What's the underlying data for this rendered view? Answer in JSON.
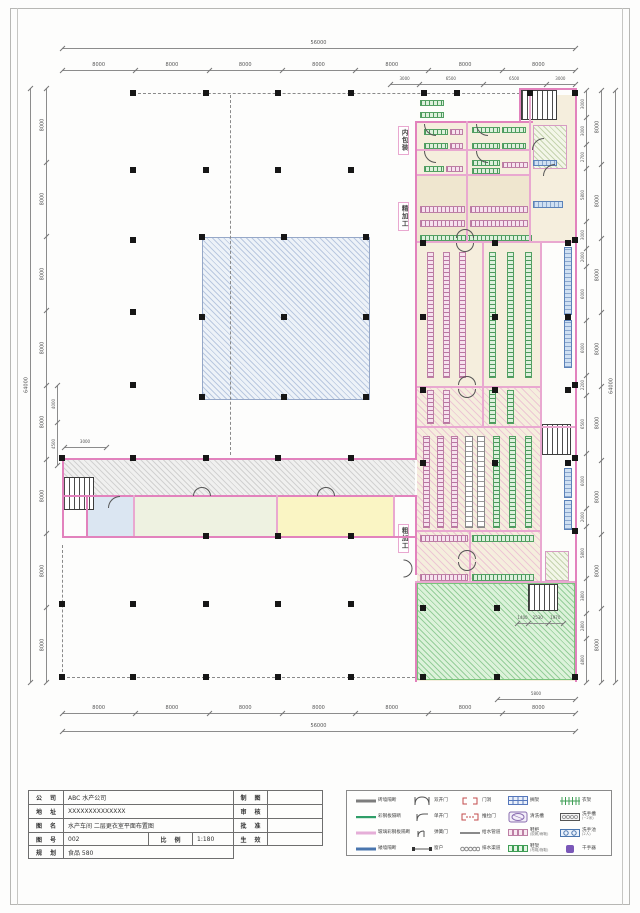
{
  "dims": {
    "top_total": "56000",
    "top": [
      "8000",
      "8000",
      "8000",
      "8000",
      "8000",
      "8000",
      "8000"
    ],
    "top_sub": [
      "3000",
      "6500",
      "6500",
      "3000"
    ],
    "bottom": [
      "8000",
      "8000",
      "8000",
      "8000",
      "8000",
      "8000",
      "8000"
    ],
    "bottom_total": "56000",
    "bottom_sub": "5800",
    "left_total": "64000",
    "left": [
      "8000",
      "8000",
      "8000",
      "8000",
      "8000",
      "8000",
      "8000",
      "8000"
    ],
    "left_sub": [
      "4000",
      "4500"
    ],
    "left_3000": "3000",
    "right_inner": [
      "3000",
      "3000",
      "2700",
      "5800",
      "3000",
      "2000",
      "6000",
      "6000",
      "2200",
      "6500",
      "6000",
      "2000",
      "5800",
      "3800",
      "2800",
      "4800"
    ],
    "right_outer": [
      "8000",
      "8000",
      "8000",
      "8000",
      "8000",
      "8000",
      "8000",
      "8000"
    ],
    "right_total": "64000",
    "laundry": [
      "1400",
      "2530",
      "1970"
    ]
  },
  "rooms": {
    "pool": "蓄水池",
    "medical": "医务室",
    "rest": "休息室",
    "toilet": "卫生间",
    "laundry": "洗衣房",
    "zone_inner_packaging": "内包装",
    "zone_fine_processing": "精加工",
    "zone_rough_processing": "粗加工",
    "g1": "公一更",
    "g2": "公二更",
    "m1s": "男一更",
    "m2s": "男二更",
    "m1b": "男一更",
    "m2b": "男二更",
    "f1": "女一更",
    "f2": "女二更",
    "p2": "公二更",
    "p1": "公一更",
    "m1c": "男一更",
    "m2c": "男二更",
    "shower": "洗手",
    "air_shower": "风淋室",
    "stair_note": "FL上"
  },
  "titleblock": {
    "company_label": "公 司",
    "company": "ABC 水产公司",
    "address_label": "地 址",
    "address": "XXXXXXXXXXXXXX",
    "drawing_label": "图 名",
    "drawing": "水产车间 二层更衣室平面布置图",
    "number_label": "图 号",
    "number": "002",
    "scale_label": "比 例",
    "scale": "1:180",
    "plan_label": "规 划",
    "plan": "食品 580",
    "draft_label": "制 图",
    "review_label": "审 核",
    "approve_label": "批 准",
    "effective_label": "生 效"
  },
  "legend": {
    "rows": [
      [
        {
          "icon": "brick-wall-icon",
          "label": "砖墙隔断"
        },
        {
          "icon": "double-door-icon",
          "label": "双开门"
        },
        {
          "icon": "door-opening-icon",
          "label": "门洞"
        },
        {
          "icon": "shelf-grid-icon",
          "label": "搁架"
        },
        {
          "icon": "clothes-rack-icon",
          "label": "衣架"
        }
      ],
      [
        {
          "icon": "steel-wall-icon",
          "label": "彩钢板隔断"
        },
        {
          "icon": "single-door-icon",
          "label": "单开门"
        },
        {
          "icon": "sliding-door-icon",
          "label": "推拉门"
        },
        {
          "icon": "wash-sink-icon",
          "label": "清洗槽"
        },
        {
          "icon": "hand-trough-icon",
          "label": "洗手槽",
          "note": "(~2米)"
        }
      ],
      [
        {
          "icon": "glass-wall-icon",
          "label": "玻璃彩钢板隔断"
        },
        {
          "icon": "spring-door-icon",
          "label": "弹簧门"
        },
        {
          "icon": "water-pipe-icon",
          "label": "给水管道"
        },
        {
          "icon": "shoe-cabinet-icon",
          "label": "鞋柜",
          "note": "(胶靴/雨靴)"
        },
        {
          "icon": "hand-basin-icon",
          "label": "洗手池",
          "note": "(2人)"
        }
      ],
      [
        {
          "icon": "low-wall-icon",
          "label": "矮墙隔断"
        },
        {
          "icon": "window-icon",
          "label": "窗户"
        },
        {
          "icon": "drain-channel-icon",
          "label": "排水渠道"
        },
        {
          "icon": "shoe-rack-icon",
          "label": "鞋架",
          "note": "(布鞋/拖鞋)"
        },
        {
          "icon": "hand-dryer-icon",
          "label": "干手器"
        }
      ]
    ]
  },
  "colors": {
    "wall_pink": "#e282bd",
    "locker_green": "#53a063",
    "locker_pink": "#bd7fa5",
    "pool_blue": "#96a8c8",
    "laundry_green": "#79c37b",
    "trough_blue": "#5b82b8"
  }
}
